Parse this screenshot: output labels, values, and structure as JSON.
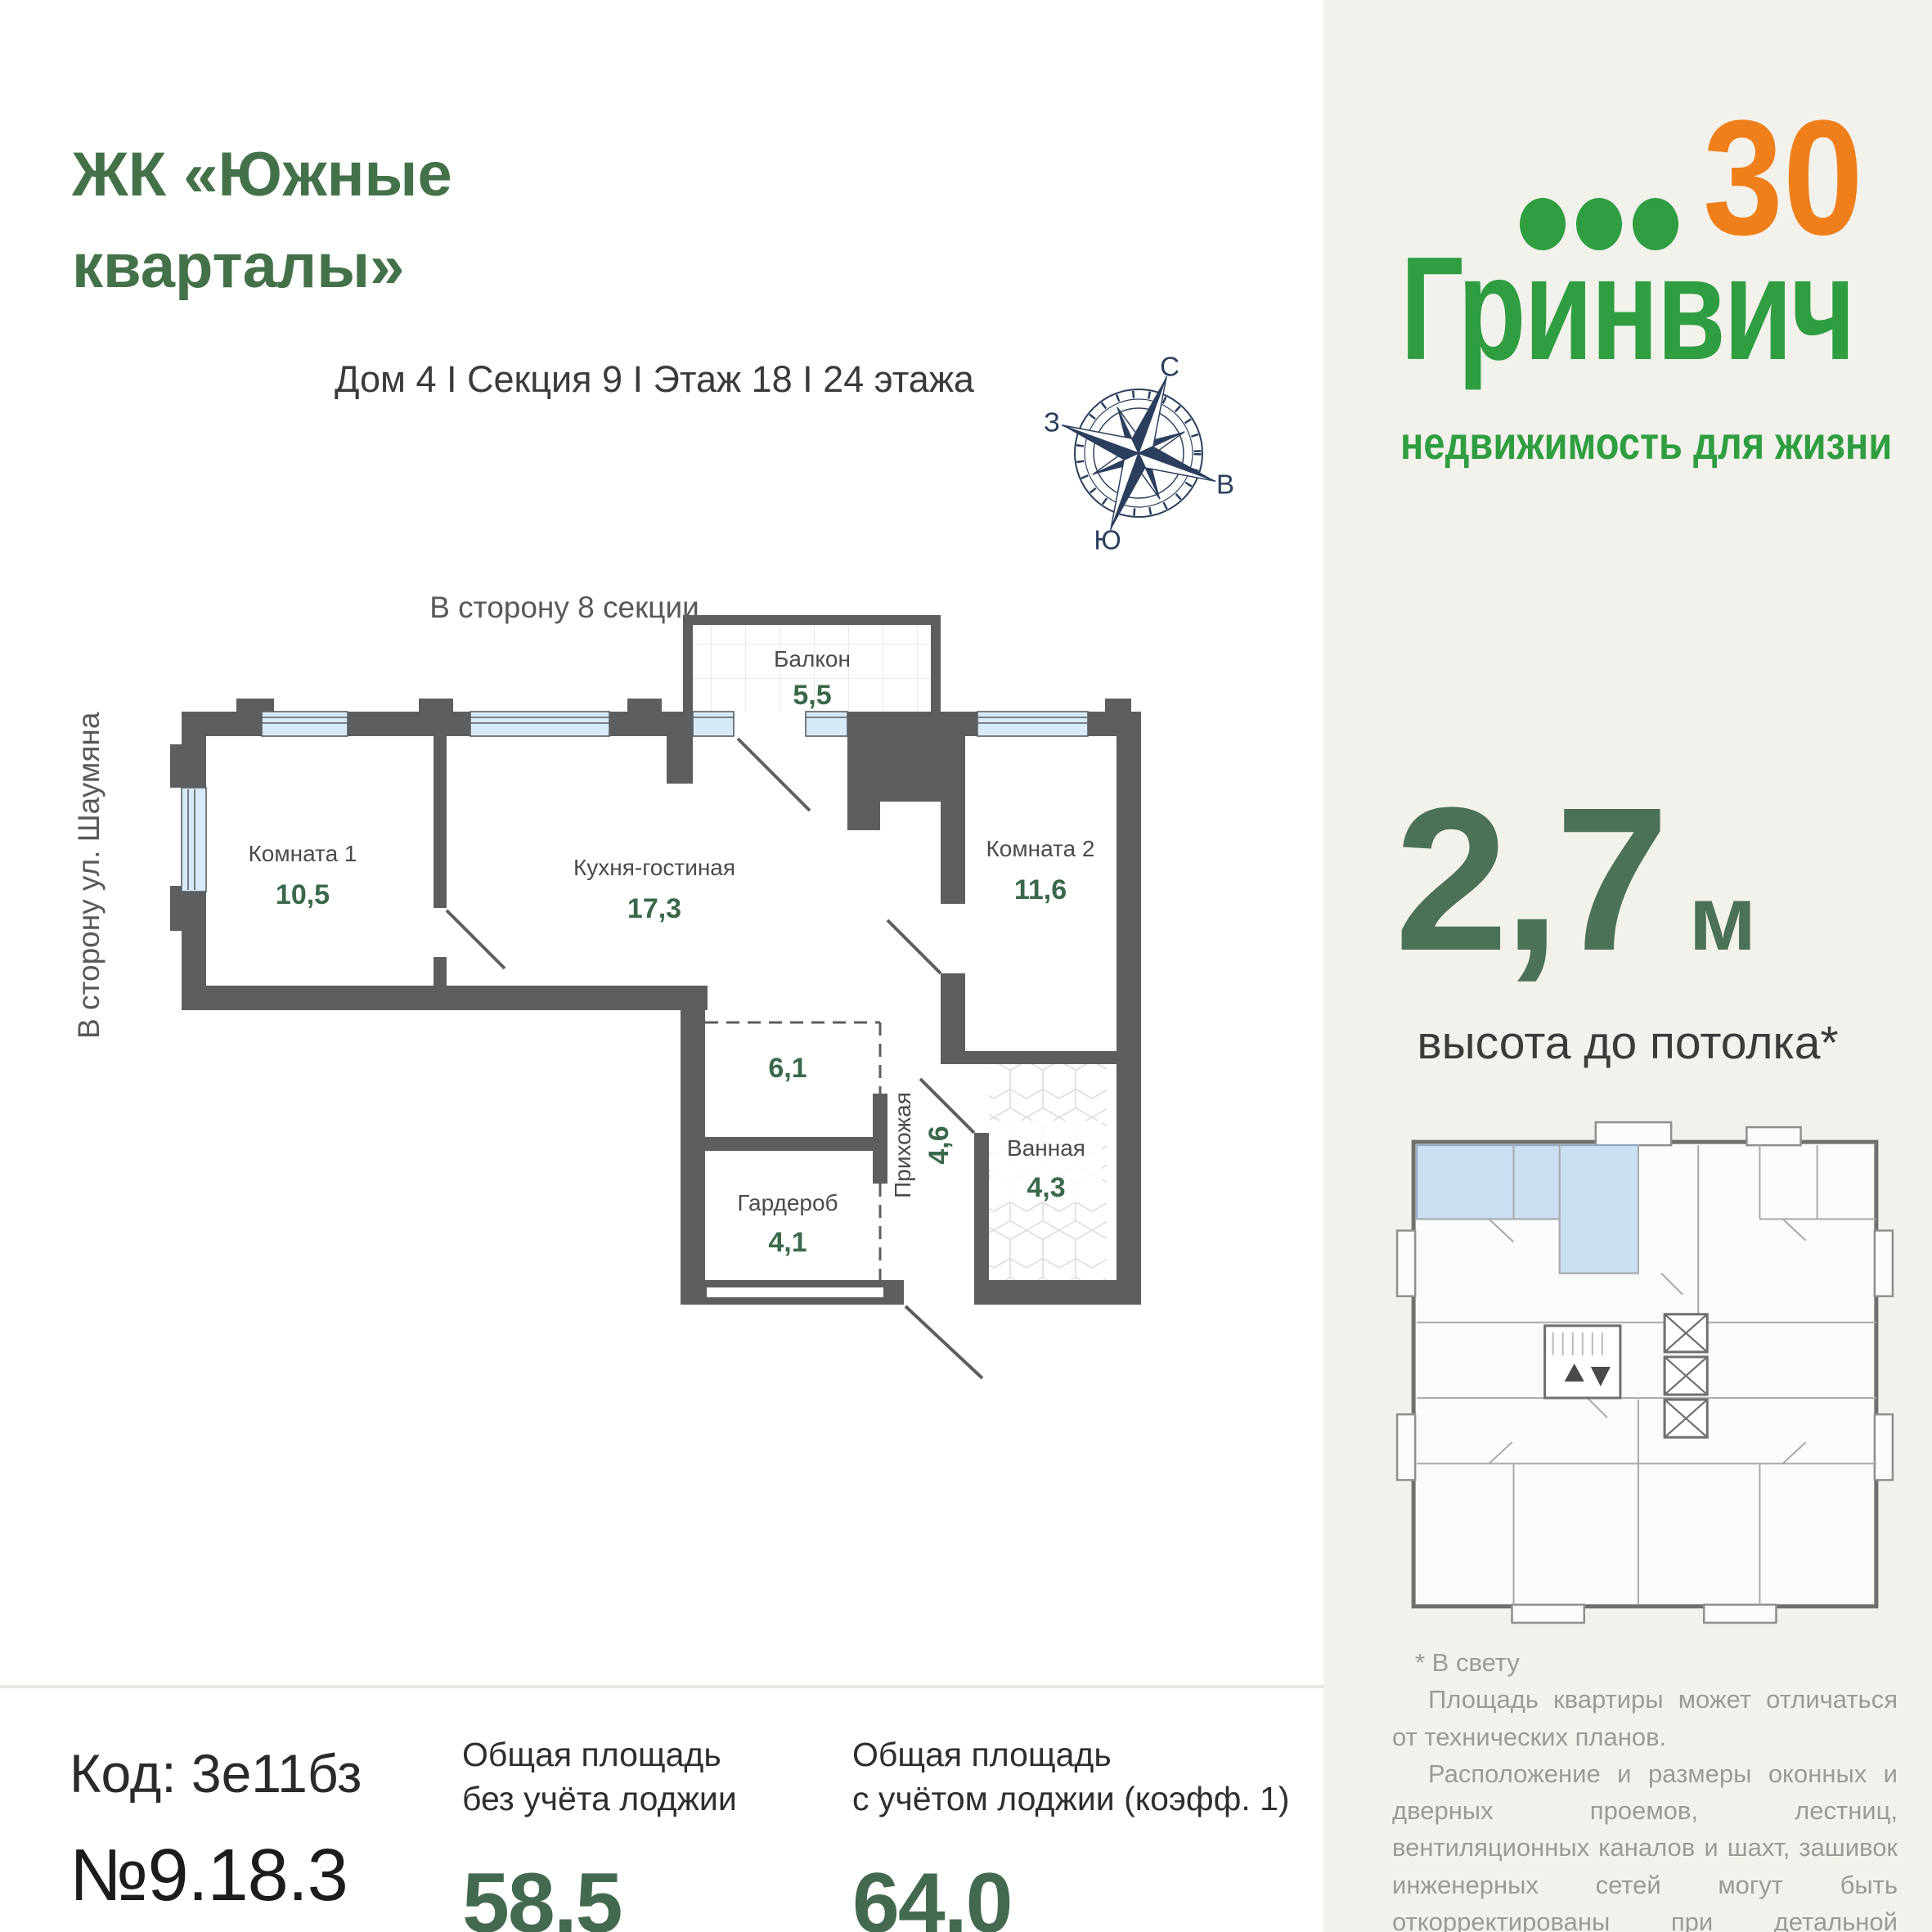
{
  "page": {
    "title_line1": "ЖК «Южные",
    "title_line2": "кварталы»",
    "subtitle": "Дом 4 I Секция 9 I Этаж 18 I 24 этажа"
  },
  "compass": {
    "north": "С",
    "south": "Ю",
    "west": "З",
    "east": "В"
  },
  "plan": {
    "direction_top": "В сторону 8 секции",
    "direction_left": "В сторону ул. Шаумяна",
    "rooms": [
      {
        "name": "Балкон",
        "area": "5,5"
      },
      {
        "name": "Комната 1",
        "area": "10,5"
      },
      {
        "name": "Кухня-гостиная",
        "area": "17,3"
      },
      {
        "name": "Комната 2",
        "area": "11,6"
      },
      {
        "name": "",
        "area": "6,1"
      },
      {
        "name": "Прихожая",
        "area": "4,6"
      },
      {
        "name": "Гардероб",
        "area": "4,1"
      },
      {
        "name": "Ванная",
        "area": "4,3"
      }
    ]
  },
  "sidebar": {
    "logo": {
      "anniversary": "30",
      "brand": "Гринвич",
      "tagline": "недвижимость для жизни"
    },
    "ceiling": {
      "value": "2,7",
      "unit": "м",
      "label": "высота до потолка*"
    },
    "disclaimer": {
      "note": "* В свету",
      "p1": "Площадь квартиры может отличаться от технических планов.",
      "p2": "Расположение и размеры оконных и дверных проемов, лестниц, вентиляционных каналов и шахт, зашивок инженерных сетей могут быть откорректированы при детальной разработке рабочей документации."
    }
  },
  "footer": {
    "code": "Код: 3е11бз",
    "number": "№9.18.3",
    "area_without": {
      "label_line1": "Общая площадь",
      "label_line2": "без учёта лоджии",
      "value": "58,5"
    },
    "area_with": {
      "label_line1": "Общая площадь",
      "label_line2": "с учётом лоджии (коэфф. 1)",
      "value": "64,0"
    }
  },
  "colors": {
    "brand_green": "#2f9e41",
    "brand_orange": "#ef7f1a",
    "heading_green": "#437149",
    "area_green": "#3a684c",
    "wall_gray": "#5d5e60",
    "window_blue": "#d7eaf8",
    "highlight_blue": "#cadff2",
    "sidebar_bg": "#f3f1eb",
    "compass_navy": "#2c3e5d"
  }
}
